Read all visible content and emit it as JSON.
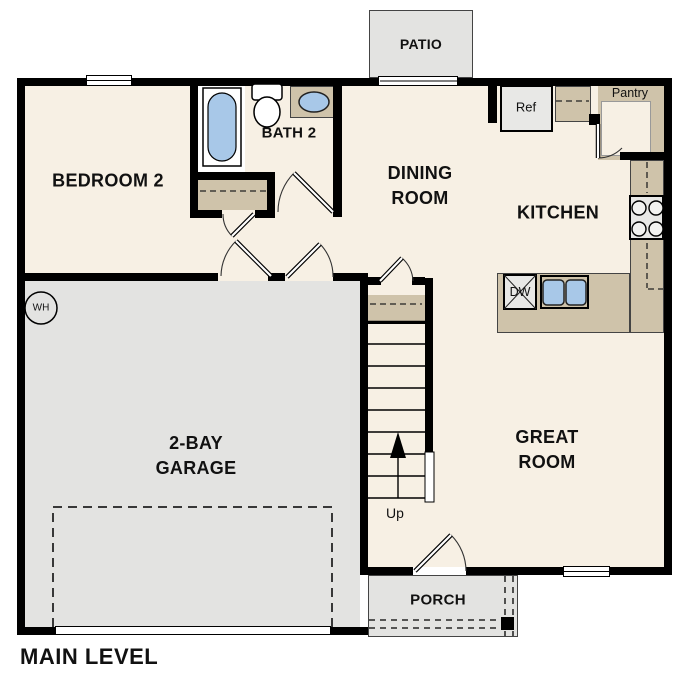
{
  "plan_title": "MAIN LEVEL",
  "labels": {
    "bedroom2": "BEDROOM 2",
    "bath2": "BATH 2",
    "dining": [
      "DINING",
      "ROOM"
    ],
    "kitchen": "KITCHEN",
    "great_room": [
      "GREAT",
      "ROOM"
    ],
    "garage": [
      "2-BAY",
      "GARAGE"
    ],
    "patio": "PATIO",
    "porch": "PORCH",
    "pantry": "Pantry",
    "ref": "Ref",
    "dw": "DW",
    "wh": "WH",
    "up": "Up"
  },
  "colors": {
    "wall": "#000000",
    "floor": "#f7f0e4",
    "concrete": "#e3e3e1",
    "counter": "#cfc3aa",
    "fixture_blue": "#a8c8e8",
    "text": "#111111"
  }
}
